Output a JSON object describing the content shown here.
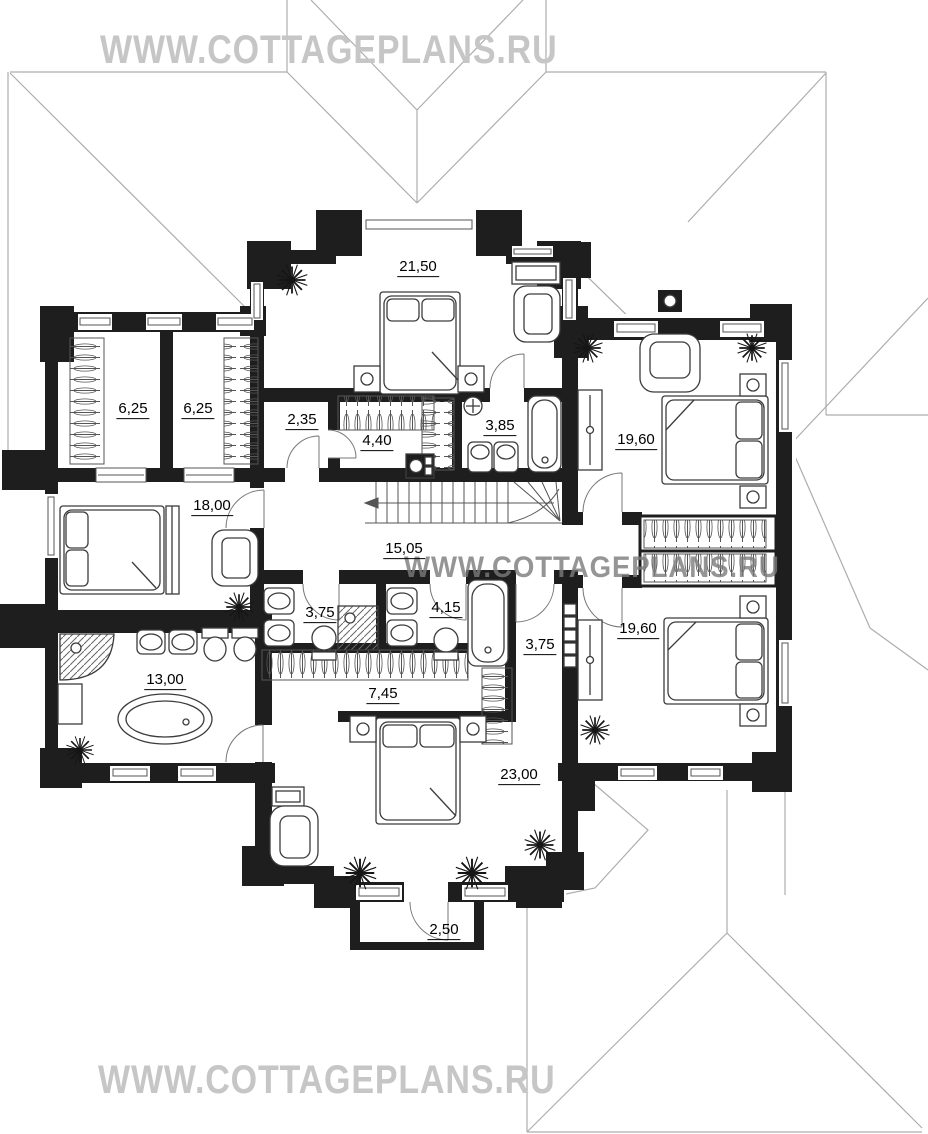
{
  "watermarks": {
    "top": "WWW.COTTAGEPLANS.RU",
    "middle": "WWW.COTTAGEPLANS.RU",
    "bottom": "WWW.COTTAGEPLANS.RU"
  },
  "rooms": [
    {
      "id": "bedroom-top",
      "area": "21,50",
      "x": 418,
      "y": 268
    },
    {
      "id": "closet-left",
      "area": "6,25",
      "x": 133,
      "y": 410
    },
    {
      "id": "closet-right",
      "area": "6,25",
      "x": 198,
      "y": 410
    },
    {
      "id": "corridor-upper",
      "area": "2,35",
      "x": 302,
      "y": 421
    },
    {
      "id": "wardrobe-upper",
      "area": "4,40",
      "x": 377,
      "y": 442
    },
    {
      "id": "bathroom-upper",
      "area": "3,85",
      "x": 500,
      "y": 427
    },
    {
      "id": "bedroom-right-top",
      "area": "19,60",
      "x": 636,
      "y": 441
    },
    {
      "id": "bedroom-left",
      "area": "18,00",
      "x": 212,
      "y": 507
    },
    {
      "id": "hall",
      "area": "15,05",
      "x": 404,
      "y": 550
    },
    {
      "id": "bathroom-left",
      "area": "3,75",
      "x": 320,
      "y": 614
    },
    {
      "id": "bathroom-center",
      "area": "4,15",
      "x": 446,
      "y": 609
    },
    {
      "id": "corridor-right",
      "area": "3,75",
      "x": 540,
      "y": 646
    },
    {
      "id": "bedroom-right-bottom",
      "area": "19,60",
      "x": 638,
      "y": 630
    },
    {
      "id": "bathroom-big",
      "area": "13,00",
      "x": 165,
      "y": 681
    },
    {
      "id": "wardrobe-lower",
      "area": "7,45",
      "x": 383,
      "y": 695
    },
    {
      "id": "bedroom-bottom",
      "area": "23,00",
      "x": 519,
      "y": 776
    },
    {
      "id": "balcony",
      "area": "2,50",
      "x": 444,
      "y": 931
    }
  ],
  "colors": {
    "wall": "#1e1e1e",
    "furniture_line": "#3c3c3c",
    "roof_line": "#adadad",
    "watermark": "#c6c6c6",
    "label_text": "#000000"
  }
}
